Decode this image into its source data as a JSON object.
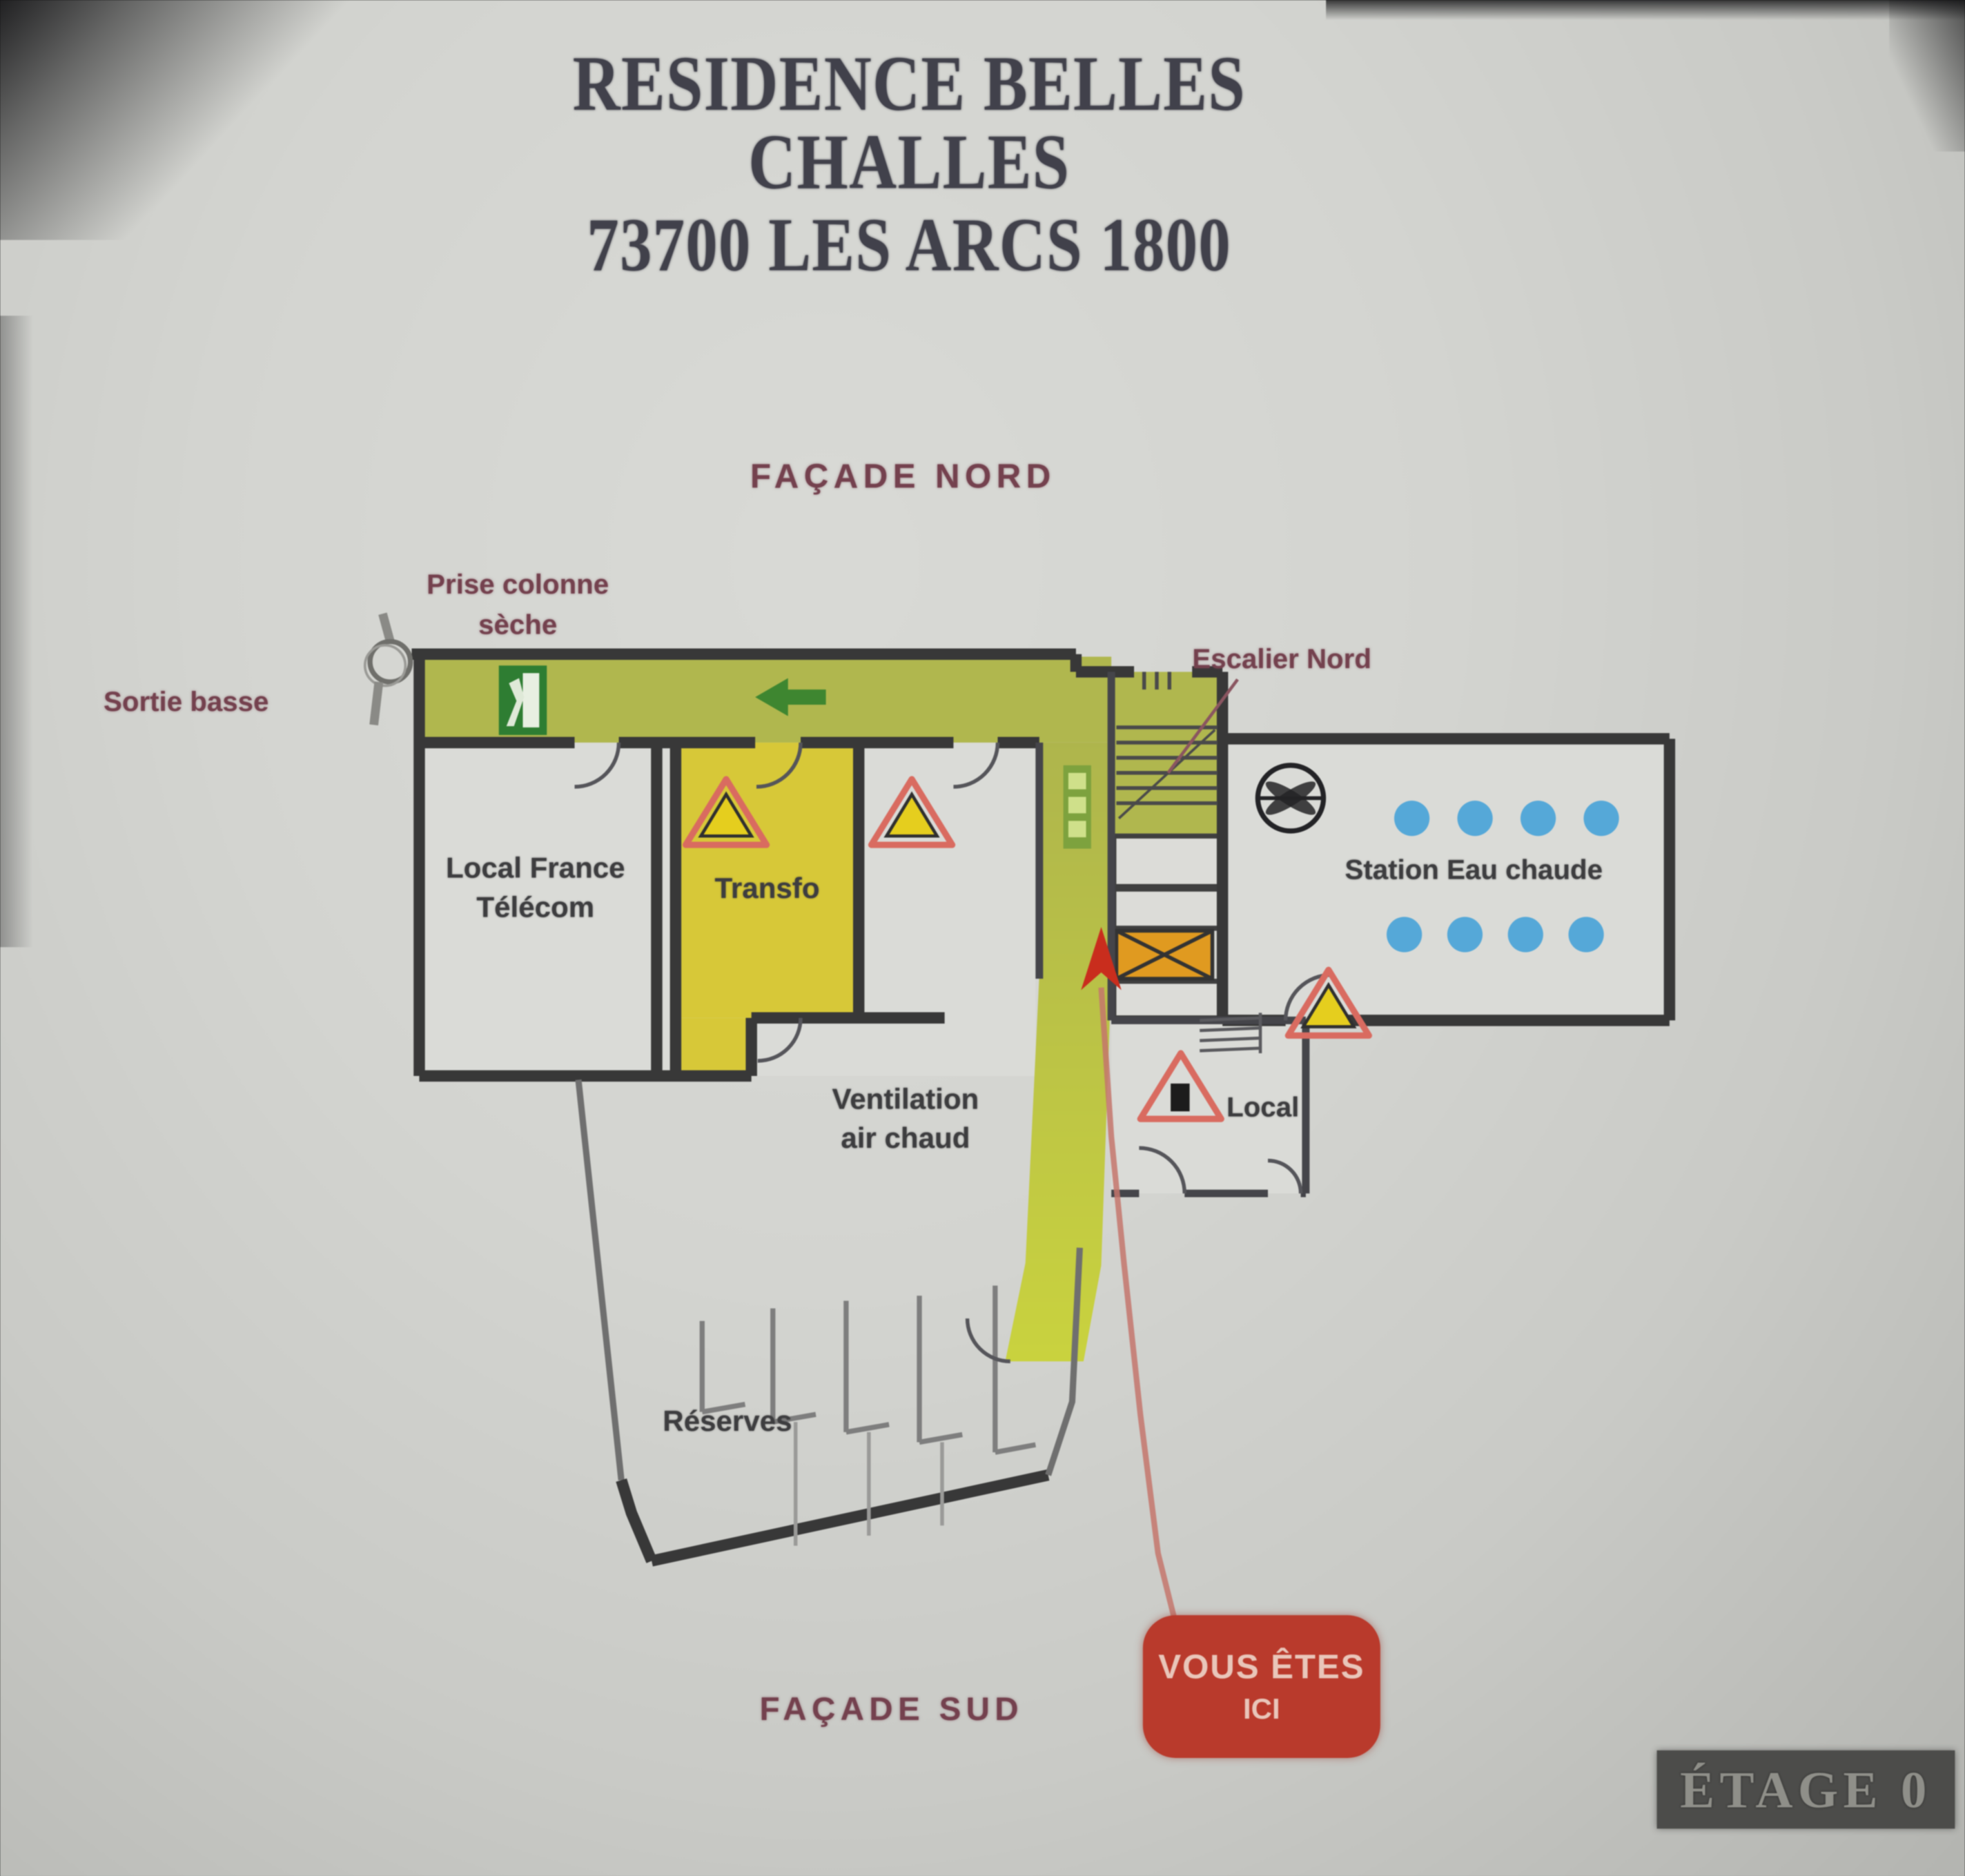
{
  "sign": {
    "title_line1": "RESIDENCE BELLES CHALLES",
    "title_line2": "73700 LES ARCS 1800",
    "floor_badge": "ÉTAGE 0"
  },
  "annotations": {
    "facade_nord": "FAÇADE NORD",
    "facade_sud": "FAÇADE SUD",
    "prise_colonne_line1": "Prise colonne",
    "prise_colonne_line2": "sèche",
    "sortie_basse": "Sortie basse",
    "escalier_nord": "Escalier Nord",
    "you_are_here_line1": "VOUS ÊTES",
    "you_are_here_line2": "ICI"
  },
  "rooms": {
    "local_france_telecom_line1": "Local France",
    "local_france_telecom_line2": "Télécom",
    "transfo": "Transfo",
    "ventilation_line1": "Ventilation",
    "ventilation_line2": "air chaud",
    "local": "Local",
    "station_eau_chaude": "Station Eau chaude",
    "reserves": "Réserves"
  },
  "icons": {
    "emergency_exit": "exit-running-man-sign",
    "direction_arrow": "green-left-arrow",
    "vertical_exit_sign": "green-exit-panel",
    "fan": "ventilation-fan-circle",
    "warning_triangle": "yellow-warning-triangle",
    "electrical_warning": "warning-triangle-black-square",
    "dry_riser": "dry-riser-intake-circle",
    "hot_water_dots": "blue-dot-grid",
    "stairs": "stair-treads",
    "electrical_unit": "orange-hatched-box",
    "you_are_here_arrow": "red-up-arrow"
  },
  "hot_water_dots": {
    "rows": 2,
    "dots_per_row": 4
  },
  "warning_triangle_count": 4,
  "colors": {
    "corridor_green": "#b0b74e",
    "transfo_yellow": "#d7c838",
    "wall_dark": "#383838",
    "accent_red_box": "#b93a2c",
    "blue_dot": "#55a8d8",
    "orange_unit": "#e09a20",
    "label_maroon": "#74414e",
    "badge_bg": "#4c4c4a",
    "exit_green": "#2e7d32",
    "path_red": "#c4766c"
  }
}
